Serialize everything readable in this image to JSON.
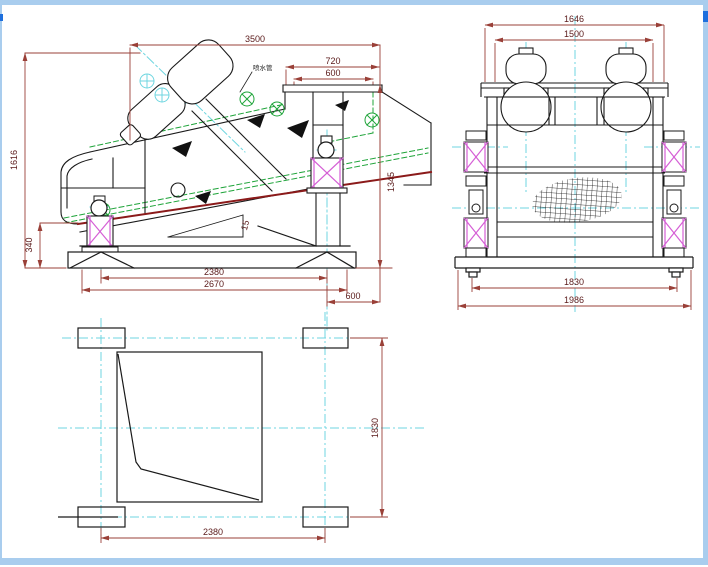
{
  "drawing": {
    "title": "vibrating-screen-three-view-cad-drawing",
    "side_view": {
      "dims": {
        "length": "3500",
        "top_width": "720",
        "top_inner": "600",
        "height": "1616",
        "feed_height": "340",
        "right_height": "1345",
        "base_span": "2380",
        "base_length": "2670",
        "overhang": "600",
        "angle": "15",
        "spray_label": "喷水管"
      }
    },
    "front_view": {
      "dims": {
        "overall_width": "1646",
        "motor_span": "1500",
        "leg_span": "1830",
        "base_width": "1986"
      }
    },
    "plan_view": {
      "dims": {
        "length": "2380",
        "width": "1830"
      }
    },
    "colors": {
      "outline": "#1a1a1a",
      "dimension_line": "#9a4038",
      "dimension_text": "#5a1a1a",
      "centerline": "#6fd6e0",
      "spray_pipe_green": "#1fa43a",
      "spring_magenta": "#d55fd5",
      "deck_red": "#8b1a1a",
      "frame_border": "#a9cdee",
      "frame_accent": "#1e6fdd"
    }
  }
}
